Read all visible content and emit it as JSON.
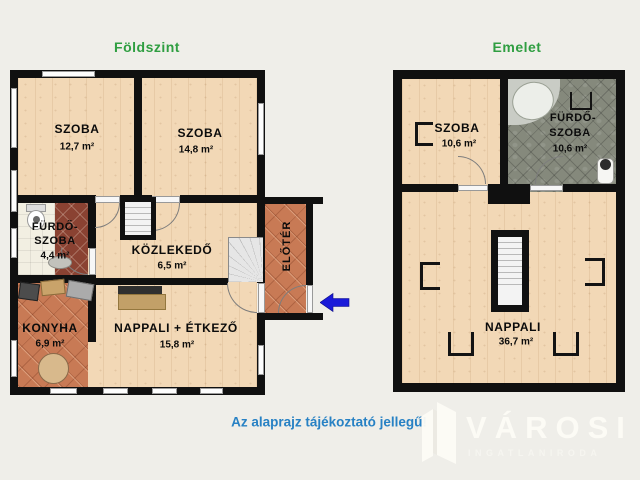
{
  "header": {
    "ground_title": "Földszint",
    "upper_title": "Emelet"
  },
  "footer": {
    "disclaimer": "Az alaprajz tájékoztató jellegű!"
  },
  "watermark": {
    "brand": "VÁROSI",
    "tagline": "INGATLANIRODA"
  },
  "ground_floor": {
    "room_szoba1": {
      "name": "SZOBA",
      "area": "12,7 m²"
    },
    "room_szoba2": {
      "name": "SZOBA",
      "area": "14,8 m²"
    },
    "room_furdoszoba": {
      "name_line1": "FÜRDŐ-",
      "name_line2": "SZOBA",
      "area": "4,4 m²"
    },
    "room_kozlekedo": {
      "name": "KÖZLEKEDŐ",
      "area": "6,5 m²"
    },
    "room_eloter": {
      "name": "ELŐTÉR"
    },
    "room_konyha": {
      "name": "KONYHA",
      "area": "6,9 m²"
    },
    "room_nappali": {
      "name": "NAPPALI + ÉTKEZŐ",
      "area": "15,8 m²"
    }
  },
  "upper_floor": {
    "room_szoba": {
      "name": "SZOBA",
      "area": "10,6 m²"
    },
    "room_furdoszoba": {
      "name_line1": "FÜRDŐ-",
      "name_line2": "SZOBA",
      "area": "10,6 m²"
    },
    "room_nappali": {
      "name": "NAPPALI",
      "area": "36,7 m²"
    }
  },
  "colors": {
    "background": "#efeee9",
    "wall": "#101010",
    "title_green": "#2f9e41",
    "disclaimer_blue": "#2781c4",
    "arrow_blue": "#1a1ad9",
    "wood_floor": "#f2d8b6",
    "terracotta_floor": "#c87a55",
    "dark_red_tile": "#8a4232",
    "white_tile": "#f2efe2",
    "green_tile": "#85897c"
  }
}
